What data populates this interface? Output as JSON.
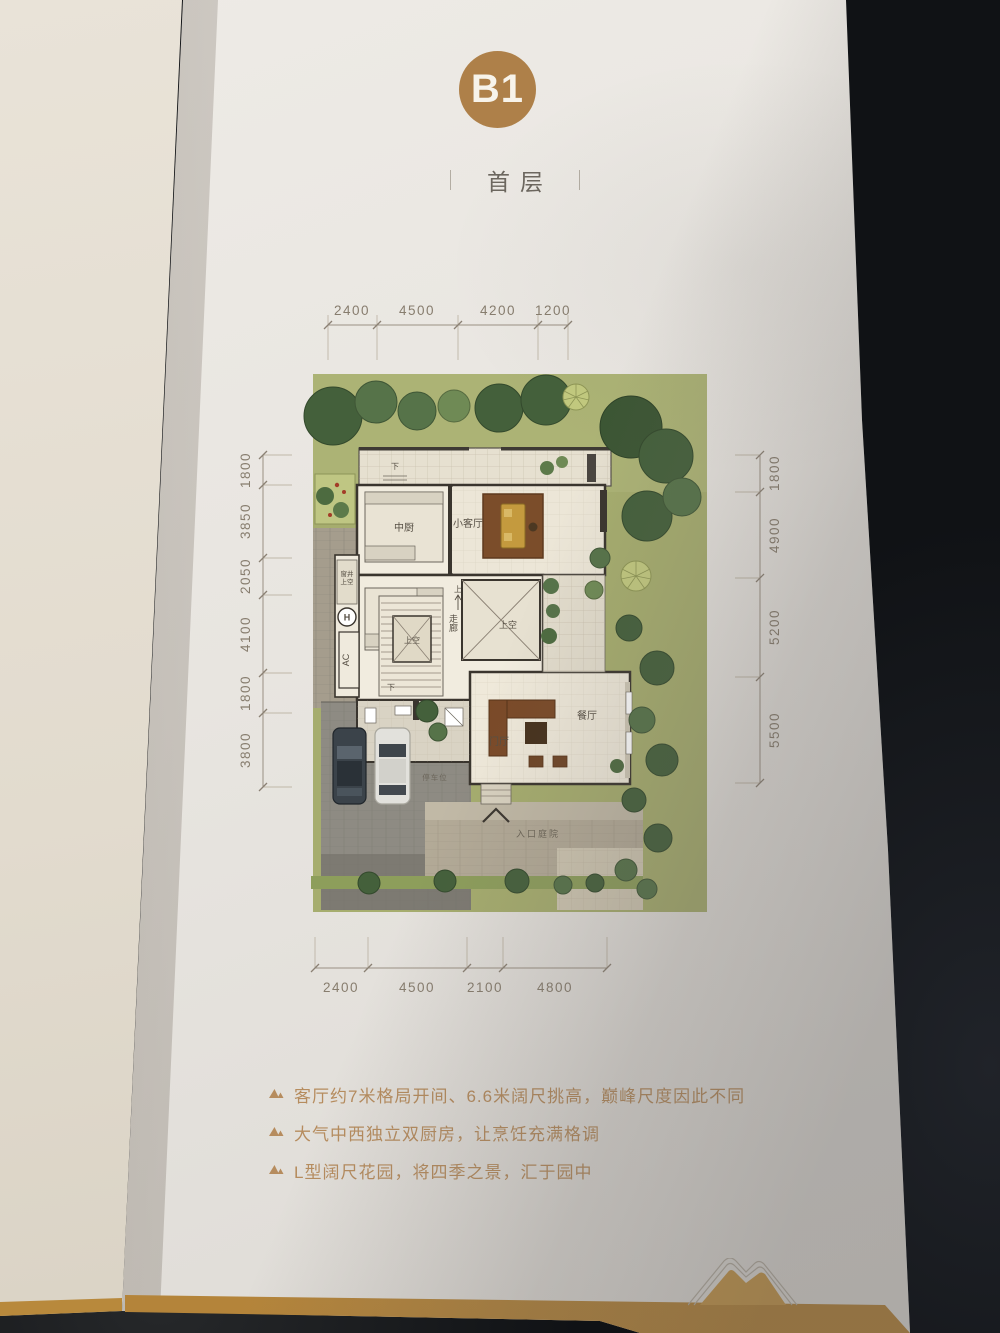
{
  "header": {
    "badge": "B1",
    "title": "首层"
  },
  "dims": {
    "top": [
      "2400",
      "4500",
      "4200",
      "1200"
    ],
    "bottom": [
      "2400",
      "4500",
      "2100",
      "4800"
    ],
    "left": [
      "1800",
      "3850",
      "2050",
      "4100",
      "1800",
      "3800"
    ],
    "right": [
      "1800",
      "4900",
      "5200",
      "5500"
    ]
  },
  "plan": {
    "rooms": {
      "chinese_kitchen": "中厨",
      "small_living": "小客厅",
      "western_kitchen": "西厨",
      "window_well_line1": "窗井",
      "window_well_line2": "上空",
      "hoist": "H",
      "ac": "AC",
      "stair_void": "上空",
      "living_void": "上空",
      "corridor": "走廊",
      "up": "上",
      "down": "下",
      "dining": "餐厅",
      "foyer": "门厅",
      "parking": "停车位",
      "entry_court": "入口庭院"
    }
  },
  "bullets": [
    {
      "text": "客厅约7米格局开间、6.6米阔尺挑高，巅峰尺度因此不同"
    },
    {
      "text": "大气中西独立双厨房，让烹饪充满格调"
    },
    {
      "text": "L型阔尺花园，将四季之景，汇于园中"
    }
  ],
  "colors": {
    "badge_gold": "#ae8049",
    "band_gold": "#c09143",
    "bullet_text": "#b68c5e",
    "dim_text": "#877d6e",
    "page": "#e9e6e1",
    "table_dark": "#131518",
    "lawn_green": "#a6ad6e",
    "tree_dark_green": "#44603b",
    "house_wall": "#3a352e",
    "rug_brown": "#7b4d2a",
    "sofa_gold": "#c49a3e"
  }
}
